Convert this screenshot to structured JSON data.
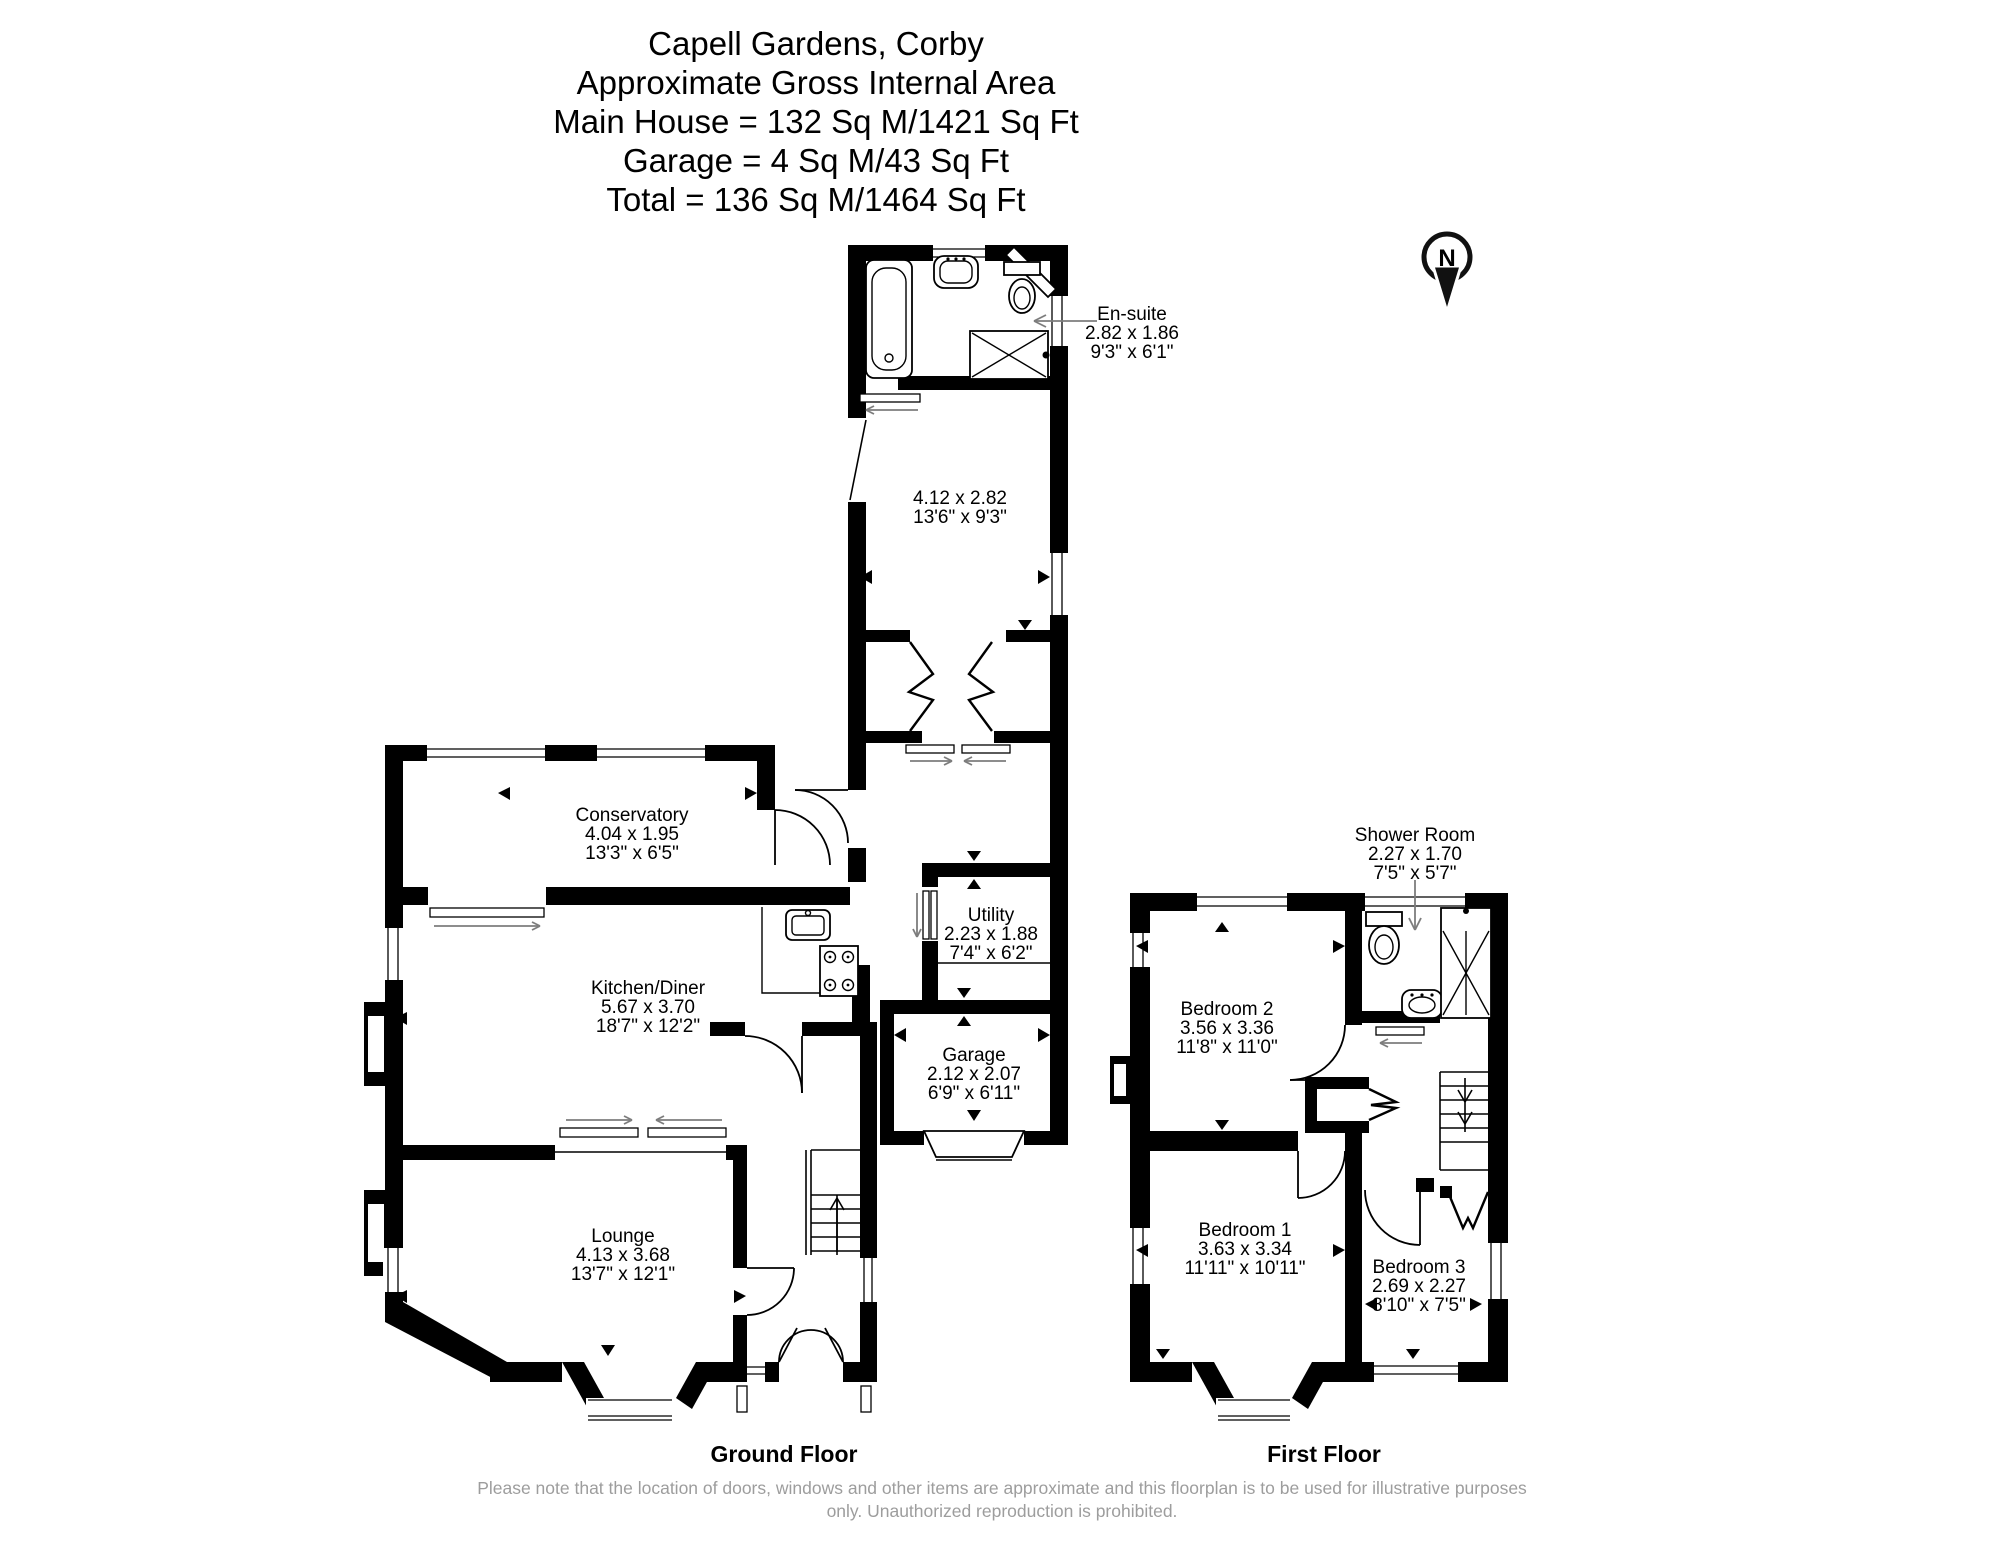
{
  "title": {
    "lines": [
      "Capell Gardens, Corby",
      "Approximate Gross Internal Area",
      "Main House = 132 Sq M/1421 Sq Ft",
      "Garage = 4 Sq M/43 Sq Ft",
      "Total = 136 Sq M/1464 Sq Ft"
    ]
  },
  "compass": {
    "label": "N"
  },
  "rooms": {
    "ensuite": {
      "name": "En-suite",
      "metric": "2.82 x 1.86",
      "imperial": "9'3\" x 6'1\""
    },
    "rear_bedroom": {
      "metric": "4.12 x 2.82",
      "imperial": "13'6\" x 9'3\""
    },
    "conservatory": {
      "name": "Conservatory",
      "metric": "4.04 x 1.95",
      "imperial": "13'3\" x 6'5\""
    },
    "kitchen_diner": {
      "name": "Kitchen/Diner",
      "metric": "5.67 x 3.70",
      "imperial": "18'7\" x 12'2\""
    },
    "utility": {
      "name": "Utility",
      "metric": "2.23 x 1.88",
      "imperial": "7'4\" x 6'2\""
    },
    "garage": {
      "name": "Garage",
      "metric": "2.12 x 2.07",
      "imperial": "6'9\" x 6'11\""
    },
    "lounge": {
      "name": "Lounge",
      "metric": "4.13 x 3.68",
      "imperial": "13'7\" x 12'1\""
    },
    "shower_room": {
      "name": "Shower Room",
      "metric": "2.27 x 1.70",
      "imperial": "7'5\" x 5'7\""
    },
    "bedroom2": {
      "name": "Bedroom 2",
      "metric": "3.56 x 3.36",
      "imperial": "11'8\" x 11'0\""
    },
    "bedroom1": {
      "name": "Bedroom 1",
      "metric": "3.63 x 3.34",
      "imperial": "11'11\" x 10'11\""
    },
    "bedroom3": {
      "name": "Bedroom 3",
      "metric": "2.69 x 2.27",
      "imperial": "8'10\" x 7'5\""
    }
  },
  "floor_labels": {
    "ground": "Ground Floor",
    "first": "First Floor"
  },
  "footer": {
    "text": "Please note that the location of doors, windows and other items are approximate and this floorplan is to be used for illustrative purposes only. Unauthorized reproduction is prohibited."
  },
  "colors": {
    "wall": "#000000",
    "annotation": "#7d7d7d",
    "footer_text": "#9d9d9d"
  }
}
